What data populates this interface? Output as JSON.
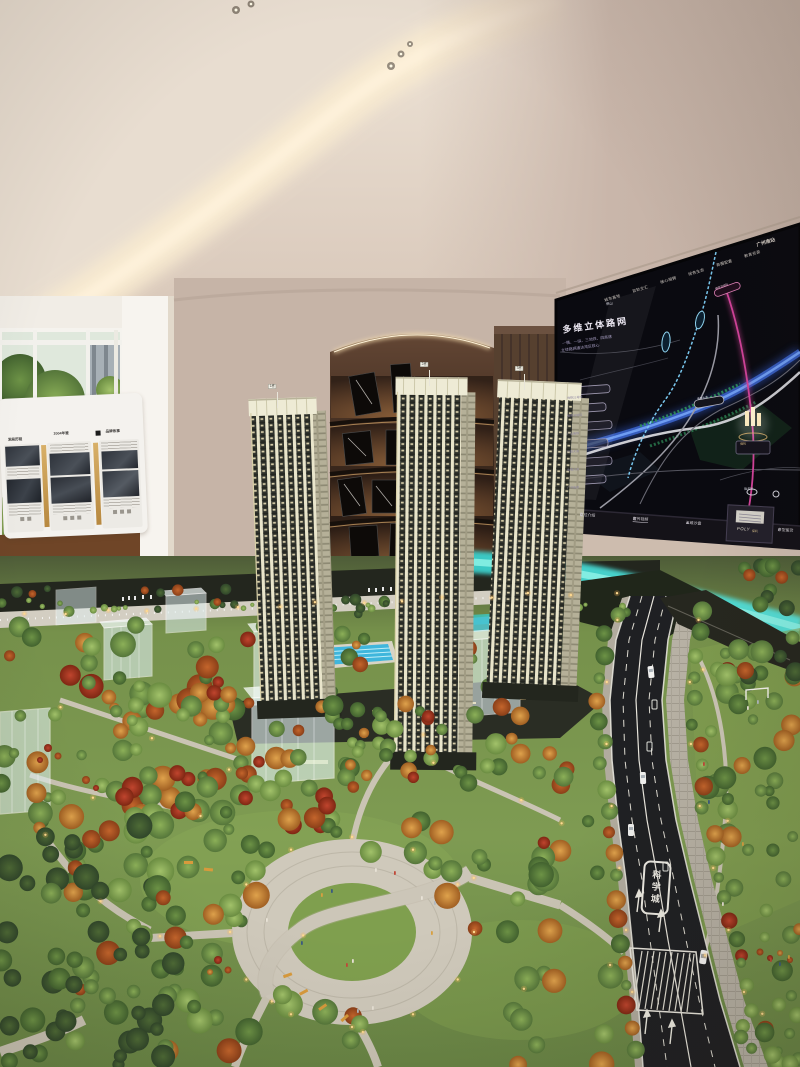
{
  "screen": {
    "title": "多维立体路网",
    "subtitle1": "一横、一纵、三地铁、四高速",
    "subtitle2": "立体路网通达湾区核心",
    "tabs": [
      "城市高地",
      "双轨交汇",
      "核心相拥",
      "绿色生态",
      "商圈配套",
      "教育资源"
    ],
    "corner_label": "广州南站",
    "legend": [
      "地铁21号线",
      "穗莞深城际",
      "广汕高铁",
      "开放大道",
      "香雪大道",
      "广河高速"
    ],
    "map_labels": {
      "city": "佛山",
      "rail_pill": "穗莞深城际",
      "road_pill": "香雪大道",
      "station": "镇龙站",
      "project": "保利"
    },
    "menu": [
      "区位介绍",
      "宣传视频",
      "三维沙盘",
      "户型鉴赏"
    ],
    "logo_text": "POLY",
    "logo_sub": "保利"
  },
  "exhibit": {
    "panels": [
      {
        "header": "发展历程"
      },
      {
        "header": "2004年鉴"
      },
      {
        "header": "品牌故事"
      }
    ]
  },
  "model": {
    "tower_tags": [
      "1栋",
      "2栋",
      "3栋"
    ],
    "road_marking": "科学城"
  },
  "colors": {
    "ceiling_cream": "#efe5d8",
    "wall_taupe": "#c6b4a7",
    "shelf_glow": "#c99a5e",
    "screen_bg": "#0a0a10",
    "map_river_blue": "#4a7ce0",
    "map_metro_pink": "#d2439a",
    "model_green": "#7a9a4d",
    "model_river_cyan": "#3fd2c8",
    "road_asphalt": "#1f2023",
    "tower_cream": "#e9e5cb"
  }
}
